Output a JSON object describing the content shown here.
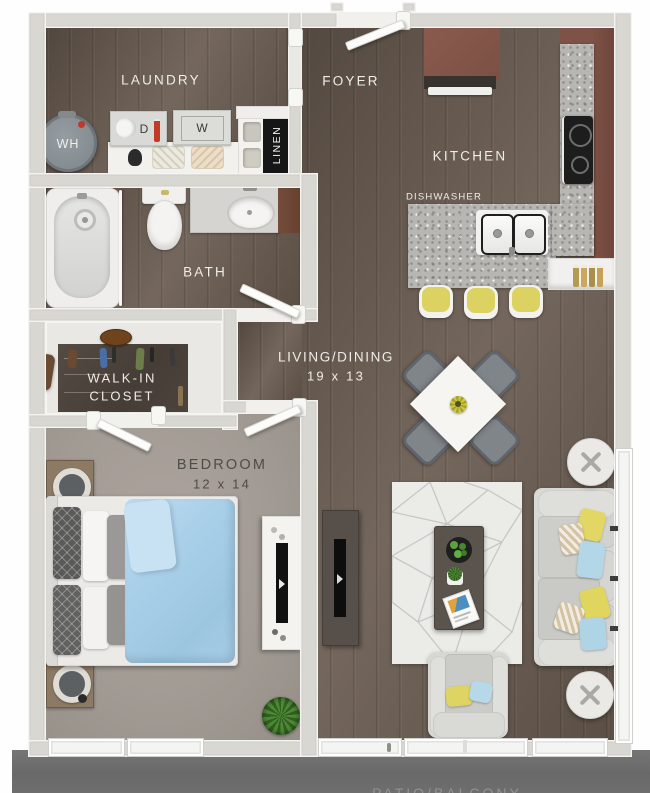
{
  "floorplan": {
    "rooms": {
      "laundry": {
        "name": "LAUNDRY"
      },
      "foyer": {
        "name": "FOYER"
      },
      "kitchen": {
        "name": "KITCHEN"
      },
      "bath": {
        "name": "BATH"
      },
      "walk_in_closet": {
        "line1": "WALK-IN",
        "line2": "CLOSET"
      },
      "bedroom": {
        "name": "BEDROOM",
        "dims": "12 x 14"
      },
      "living_dining": {
        "name": "LIVING/DINING",
        "dims": "19 x 13"
      },
      "patio": {
        "name": "PATIO/BALCONY"
      }
    },
    "fixtures": {
      "water_heater": "WH",
      "dryer": "D",
      "washer": "W",
      "linen": "LINEN",
      "dishwasher": "DISHWASHER"
    },
    "colors": {
      "wall": "#d9d7d2",
      "wood_floor": "#695b50",
      "carpet": "#a29b94",
      "closet_floor": "#4a423b",
      "patio_concrete": "#6e6e6e",
      "cabinet_brown": "#82544a",
      "granite": "#b7b6b2",
      "accent_yellow": "#dcd262",
      "accent_blue": "#aed3ea"
    }
  }
}
